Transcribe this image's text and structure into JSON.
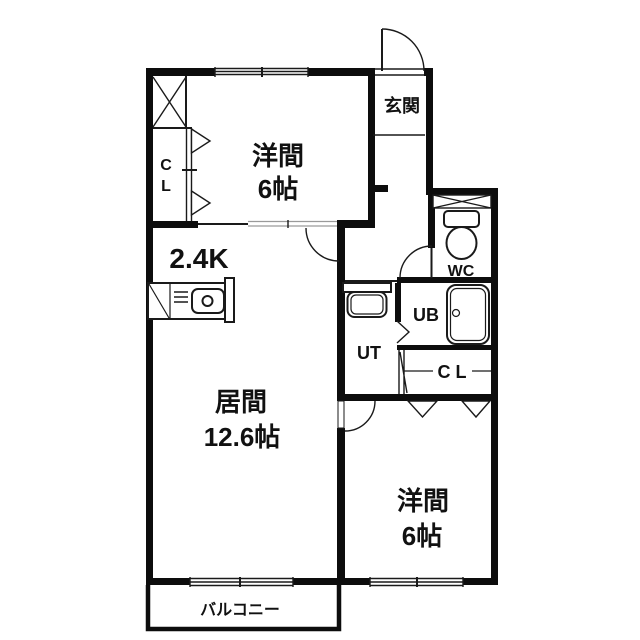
{
  "plan": {
    "type": "apartment-floorplan-2LDK",
    "colors": {
      "wall": "#0d0d0d",
      "background": "#ffffff",
      "text": "#111111"
    },
    "rooms": {
      "bedroom1": {
        "name": "洋間",
        "size": "6帖"
      },
      "bedroom2": {
        "name": "洋間",
        "size": "6帖"
      },
      "living": {
        "name": "居間",
        "size": "12.6帖"
      },
      "kitchen": {
        "label": "2.4K"
      },
      "entrance": {
        "label": "玄関"
      },
      "wc": {
        "label": "WC"
      },
      "unit_bath": {
        "label": "UB"
      },
      "utility": {
        "label": "UT"
      },
      "closet_bedroom1": {
        "line1": "C",
        "line2": "L"
      },
      "closet_bedroom2": {
        "label": "C L"
      },
      "balcony": {
        "label": "バルコニー"
      }
    }
  }
}
